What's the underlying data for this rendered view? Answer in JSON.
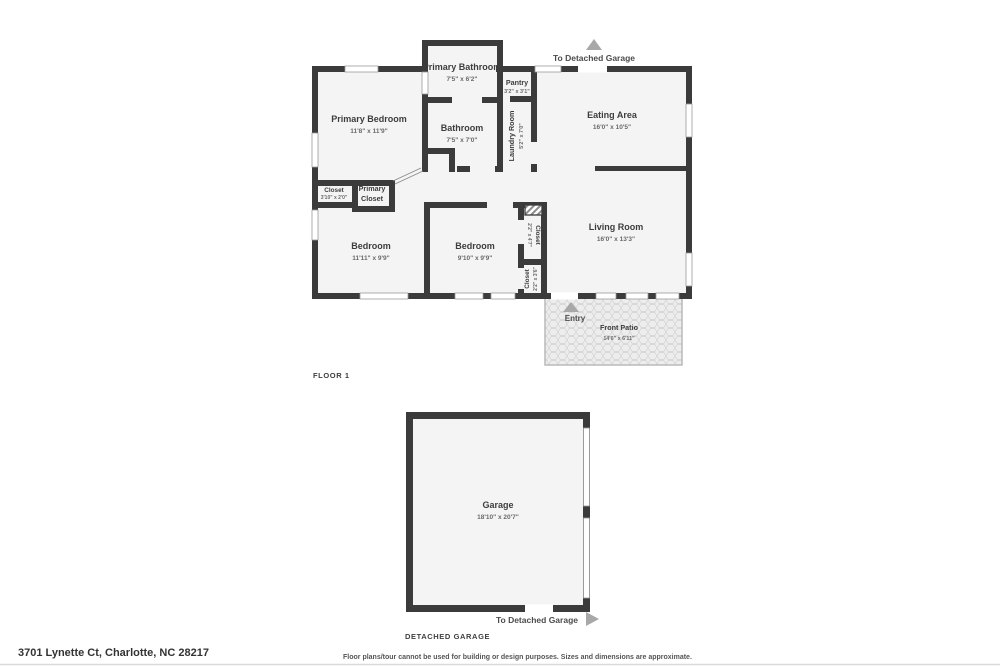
{
  "meta": {
    "floor1_label": "FLOOR 1",
    "detached_garage_label": "DETACHED GARAGE",
    "address": "3701 Lynette Ct, Charlotte, NC 28217",
    "disclaimer": "Floor plans/tour cannot be used for building or design purposes. Sizes and dimensions are approximate."
  },
  "annotations": {
    "to_garage_top": "To Detached Garage",
    "to_garage_bottom": "To Detached Garage",
    "entry": "Entry"
  },
  "colors": {
    "wall": "#3b3b3b",
    "room_fill": "#f4f4f4",
    "arrow": "#a8a8a8"
  },
  "rooms": {
    "primary_bathroom": {
      "name": "Primary Bathroom",
      "dims": "7'5\" x 6'2\""
    },
    "pantry": {
      "name": "Pantry",
      "dims": "3'2\" x 3'1\""
    },
    "laundry_room": {
      "name": "Laundry Room",
      "dims": "5'2\" x 7'0\""
    },
    "eating_area": {
      "name": "Eating Area",
      "dims": "16'0\" x 10'5\""
    },
    "primary_bedroom": {
      "name": "Primary Bedroom",
      "dims": "11'8\" x 11'9\""
    },
    "bathroom": {
      "name": "Bathroom",
      "dims": "7'5\" x 7'0\""
    },
    "closet_hall": {
      "name": "Closet",
      "dims": "3'10\" x 2'0\""
    },
    "primary_closet": {
      "name": "Primary Closet",
      "line1": "Primary",
      "line2": "Closet"
    },
    "bedroom_left": {
      "name": "Bedroom",
      "dims": "11'11\" x 9'9\""
    },
    "bedroom_middle": {
      "name": "Bedroom",
      "dims": "9'10\" x 9'9\""
    },
    "closet_tall": {
      "name": "Closet",
      "dims": "2'2\" x 4'7\""
    },
    "closet_lower": {
      "name": "Closet",
      "dims": "2'2\" x 3'6\""
    },
    "living_room": {
      "name": "Living Room",
      "dims": "16'0\" x 13'3\""
    },
    "front_patio": {
      "name": "Front Patio",
      "dims": "14'6\" x 6'11\""
    },
    "garage": {
      "name": "Garage",
      "dims": "18'10\" x 20'7\""
    }
  }
}
